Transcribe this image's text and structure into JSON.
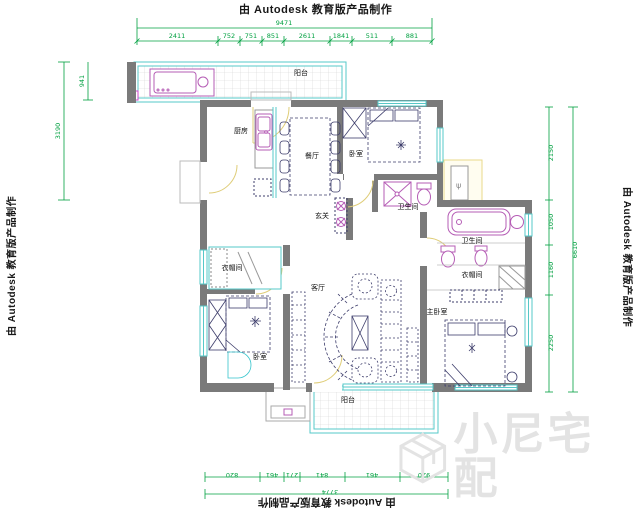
{
  "branding": {
    "autodesk_text": "由 Autodesk 教育版产品制作"
  },
  "watermark": {
    "text": "小尼宅配",
    "logo": "cube-logo"
  },
  "rooms": {
    "balcony_top": "阳台",
    "kitchen": "厨房",
    "dining": "餐厅",
    "bedroom_top": "卧室",
    "bath_shower": "卫生间",
    "entry": "玄关",
    "cloakroom": "衣帽间",
    "bath_tub": "卫生间",
    "closet": "衣帽间",
    "master": "主卧室",
    "bedroom_bottom": "卧室",
    "living": "客厅",
    "balcony_bottom": "阳台"
  },
  "dimensions": {
    "top": {
      "overall": "9471",
      "segments": [
        "2411",
        "752",
        "751",
        "851",
        "2611",
        "1841",
        "511",
        "881"
      ]
    },
    "bottom": {
      "overall": "3774",
      "segments": [
        "820",
        "461",
        "271",
        "841",
        "461",
        "920"
      ]
    },
    "left": {
      "segments": [
        "3190",
        "941"
      ]
    },
    "right": {
      "overall": "6610",
      "segments": [
        "2150",
        "1050",
        "1160",
        "2250"
      ]
    }
  },
  "colors": {
    "wall": "#7a7a7a",
    "window": "#56c8c8",
    "fixture": "#b55cb5",
    "furniture": "#3d3d6b",
    "door_arc": "#dfcd78",
    "dimension": "#00A040",
    "tile_grid": "#d4d4d4",
    "watermark": "#e3e3e3"
  }
}
